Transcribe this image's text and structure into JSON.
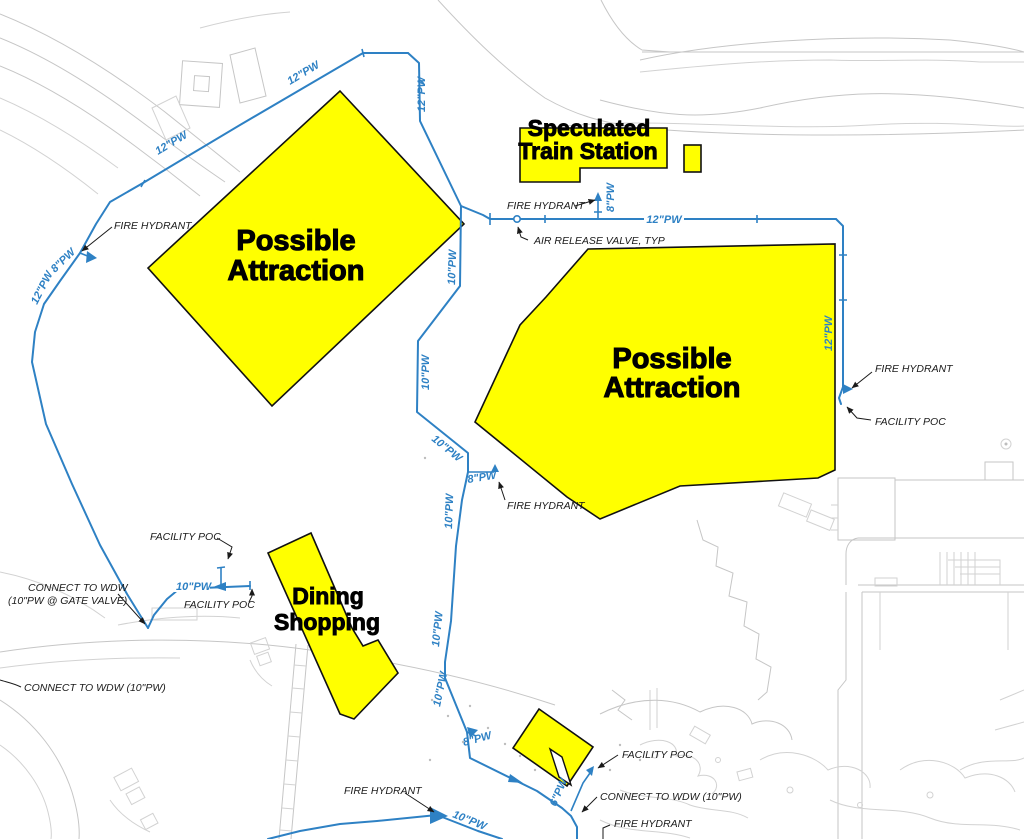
{
  "document": {
    "type": "utility-site-plan",
    "colors": {
      "pipe_blue": "#2e81c4",
      "highlight_yellow": "#ffff00",
      "linework_gray": "#c6c6c6",
      "text_black": "#1a1a1a"
    }
  },
  "areas": {
    "attraction_nw": {
      "line1": "Possible",
      "line2": "Attraction"
    },
    "attraction_east": {
      "line1": "Possible",
      "line2": "Attraction"
    },
    "train_station": {
      "line1": "Speculated",
      "line2": "Train Station"
    },
    "dining_shopping": {
      "line1": "Dining",
      "line2": "Shopping"
    }
  },
  "pipes": {
    "pw12": "12\"PW",
    "pw10": "10\"PW",
    "pw8": "8\"PW",
    "pw6": "6\"PW"
  },
  "callouts": {
    "fire_hydrant": "FIRE HYDRANT",
    "air_release_valve": "AIR RELEASE VALVE, TYP",
    "facility_poc": "FACILITY POC",
    "connect_wdw_gate_1": "CONNECT TO WDW",
    "connect_wdw_gate_2": "(10\"PW @ GATE VALVE)",
    "connect_wdw_10": "CONNECT TO WDW (10\"PW)"
  }
}
